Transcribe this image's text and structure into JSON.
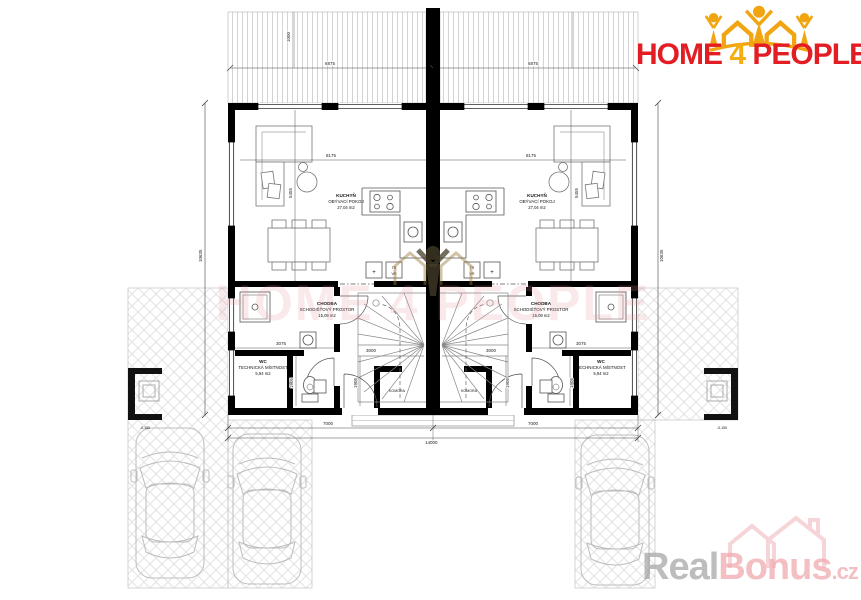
{
  "brand": {
    "home": "HOME",
    "four": "4",
    "people": "PEOPLE"
  },
  "watermarks": {
    "center_text": "HOME 4 PEOPLE",
    "real": "Real",
    "bonus": "Bonus",
    "cz": ".cz"
  },
  "rooms": {
    "living": {
      "name": "KUCHYŇ",
      "type": "OBÝVACÍ POKOJ",
      "area": "27,04 m2"
    },
    "hall": {
      "name": "CHODBA",
      "type": "SCHODIŠŤOVÝ PROSTOR",
      "area": "15,09 m2"
    },
    "wc": {
      "name": "WC",
      "type": "TECHNICKÁ MÍSTNOST",
      "area": "5,94 m2"
    },
    "storage": {
      "name": "KOMORA"
    }
  },
  "dimensions": {
    "roof_width": "6875",
    "roof_offset": "1000",
    "living_width": "8175",
    "living_height": "5455",
    "half_width": "7000",
    "total_width": "14000",
    "side_height": "10635",
    "wc_width": "3075",
    "wc_height": "1905",
    "stair_length": "3000",
    "paving_level": "-0,150"
  },
  "labels": {
    "plus": "+",
    "tr": "TR",
    "vr": "VR"
  },
  "colors": {
    "brand_red": "#e21d23",
    "brand_gold": "#f5ae10",
    "watermark_pink": "#ec9ea6",
    "real_gray": "#a7a7a9"
  }
}
